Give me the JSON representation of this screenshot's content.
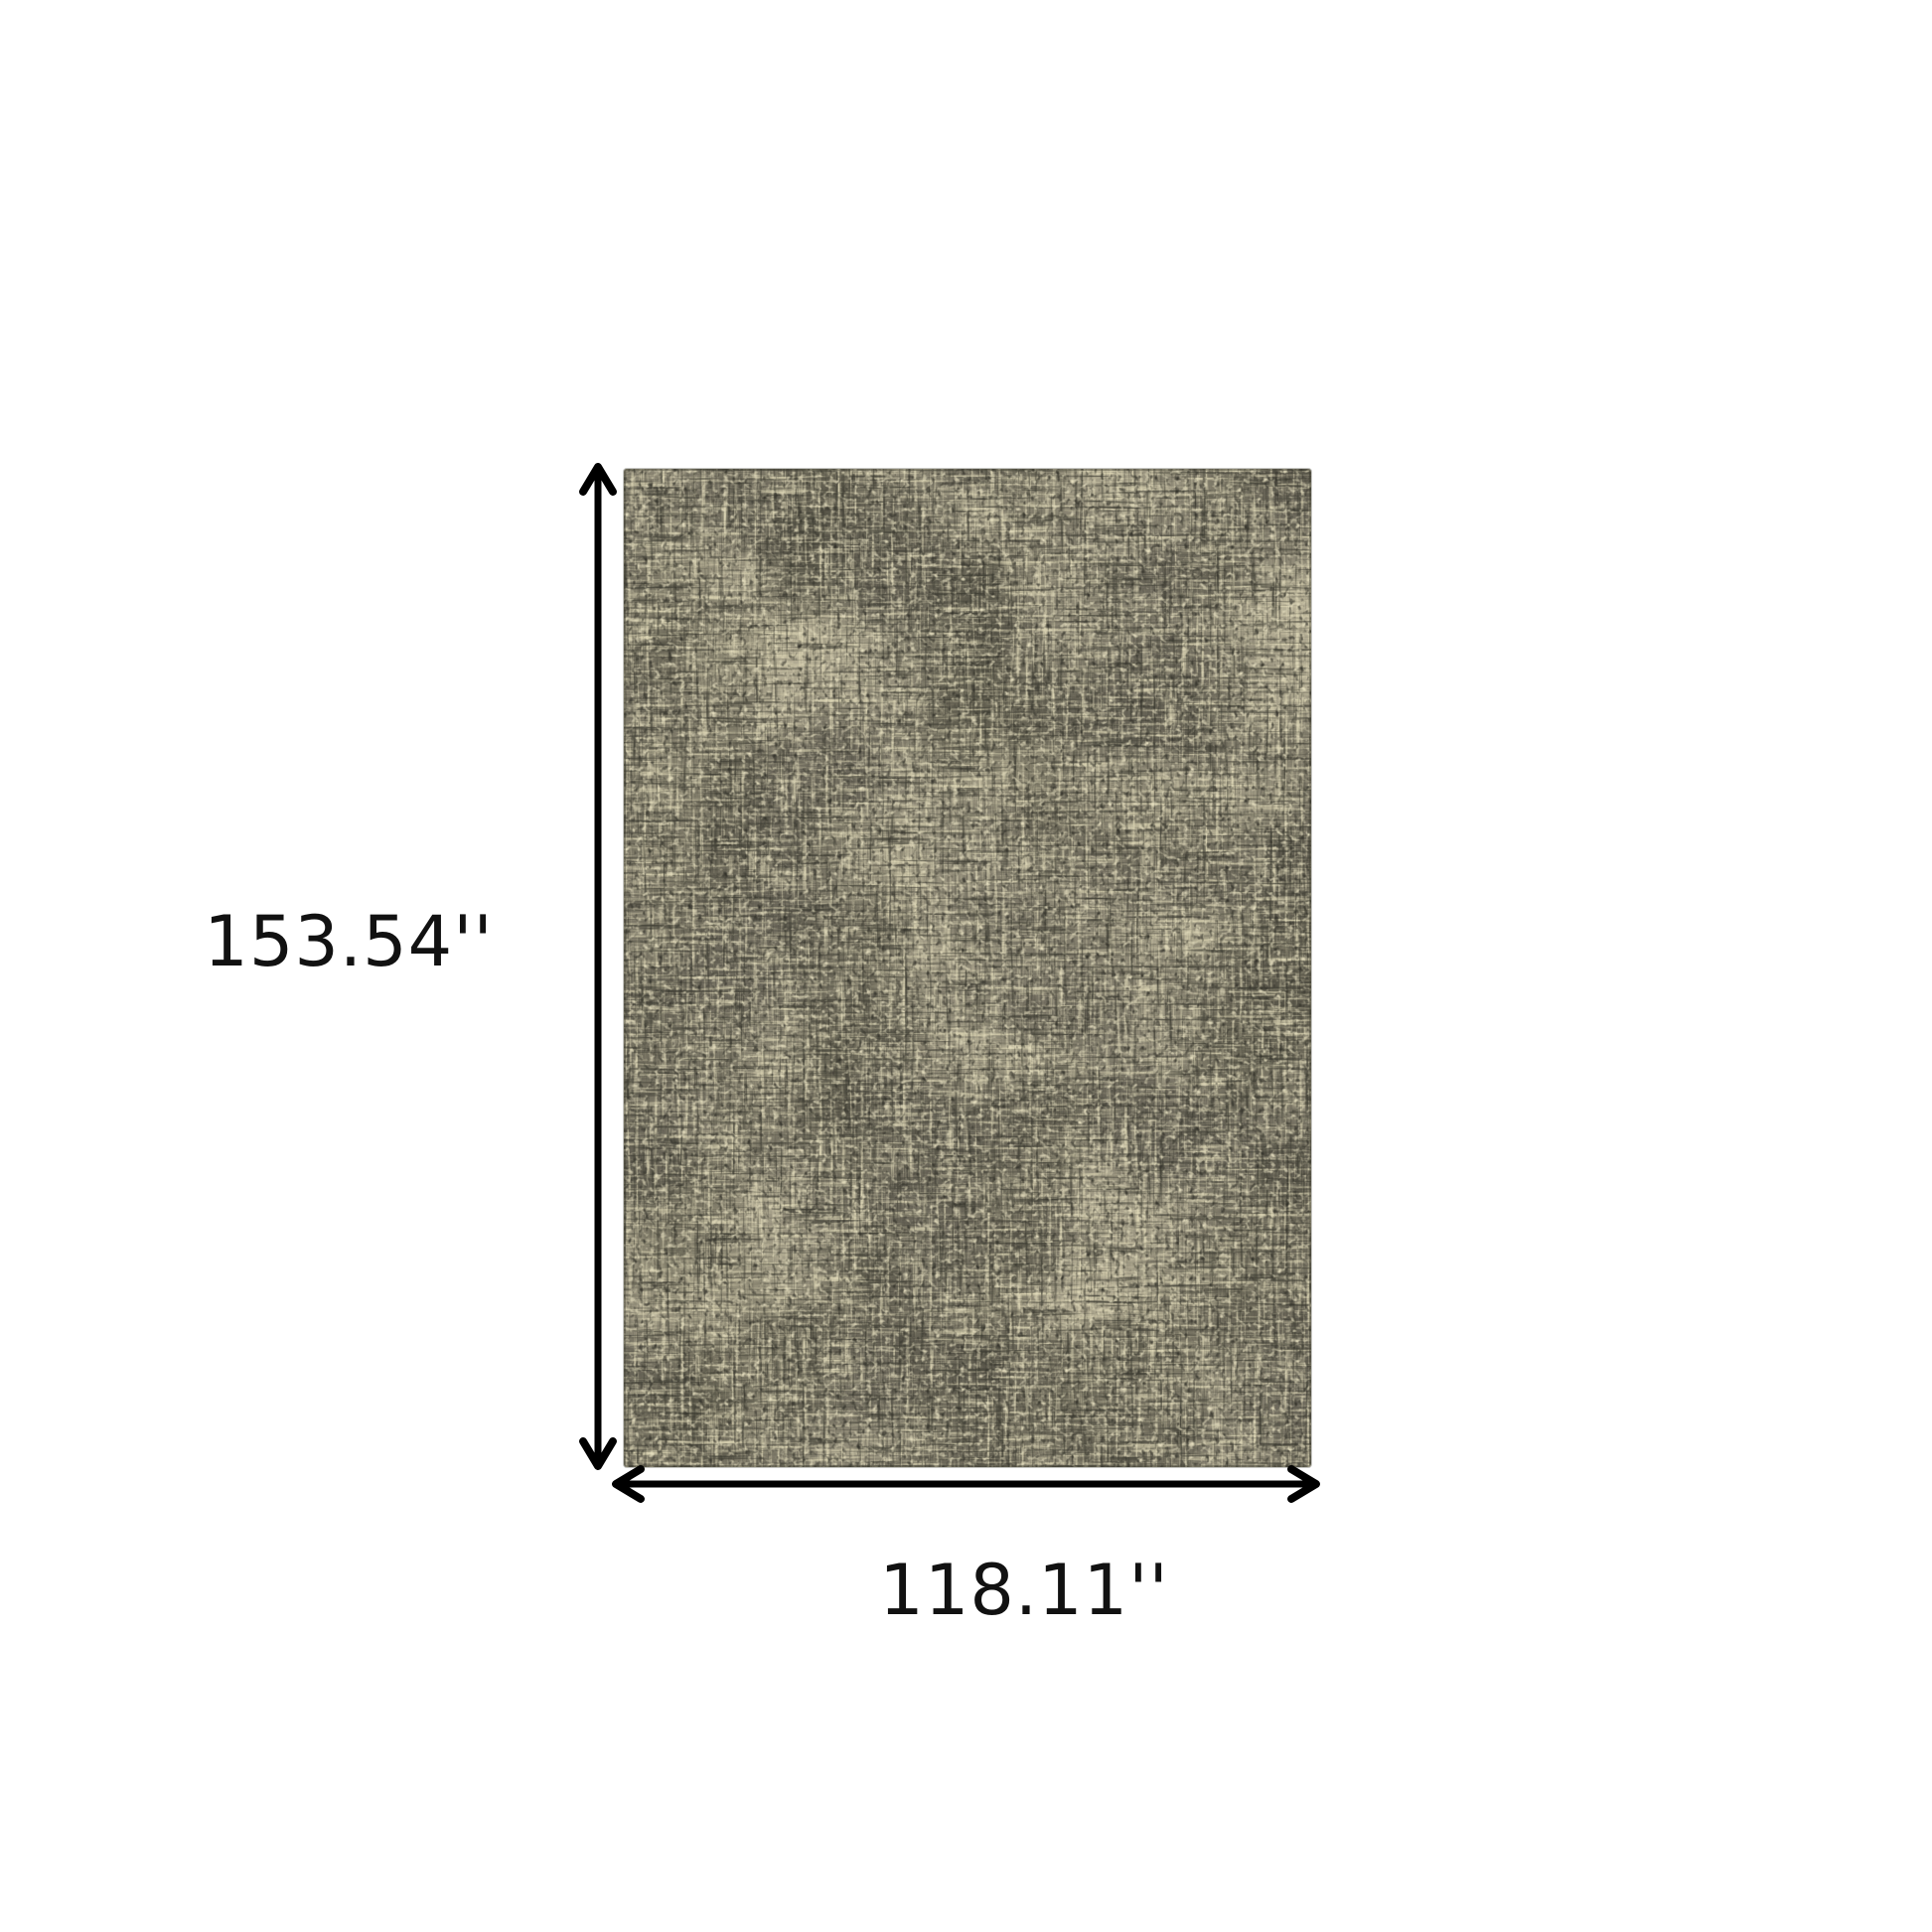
{
  "page": {
    "background_color": "#ffffff"
  },
  "diagram": {
    "kind": "product-dimension-diagram",
    "product": {
      "name": "distressed-abstract-area-rug",
      "palette": {
        "base": "#6b675a",
        "dark_charcoal": "#45443a",
        "mid_gray": "#7b7769",
        "cream": "#d8d1b0",
        "light_cream": "#e3dcbd"
      }
    },
    "dimensions": {
      "height_label": "153.54''",
      "width_label": "118.11''"
    },
    "arrow_color": "#000000",
    "label_text_color": "#111111"
  }
}
